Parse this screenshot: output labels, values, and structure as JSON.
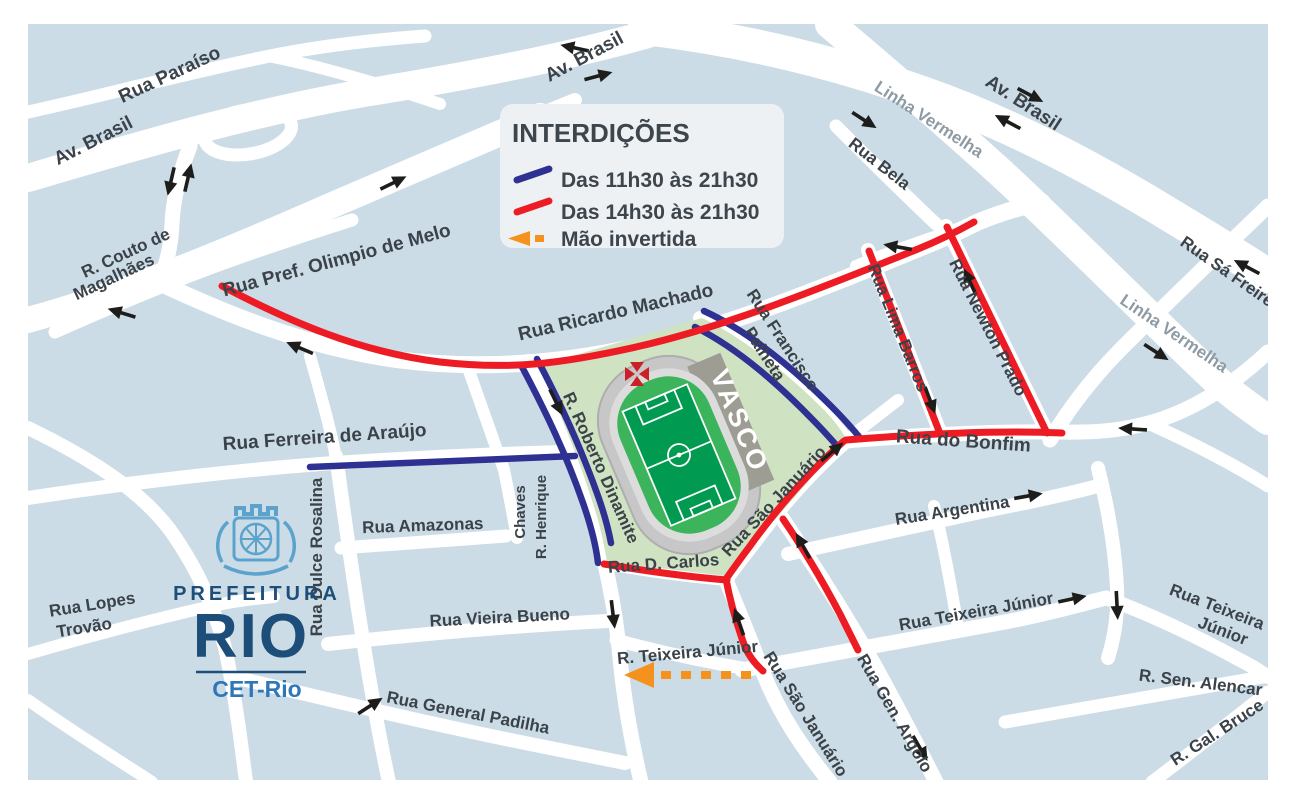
{
  "legend": {
    "title": "INTERDIÇÕES",
    "items": [
      {
        "id": "blue-closure",
        "swatch_icon": "blue-line-swatch",
        "color": "#2e3192",
        "label": "Das 11h30 às 21h30"
      },
      {
        "id": "red-closure",
        "swatch_icon": "red-line-swatch",
        "color": "#ed1c24",
        "label": "Das 14h30 às 21h30"
      },
      {
        "id": "inverted-lane",
        "swatch_icon": "orange-arrow-swatch",
        "color": "#f5921e",
        "label": "Mão invertida"
      }
    ]
  },
  "logo": {
    "prefeitura": "PREFEITURA",
    "rio": "RIO",
    "agency": "CET-Rio"
  },
  "stadium": {
    "name": "VASCO",
    "crest_icon": "vasco-cross-icon"
  },
  "icons": {
    "direction_arrow": "black one-way traffic arrow",
    "inverted_arrow": "orange dashed reversed-lane arrow"
  },
  "colors": {
    "map_background": "#cbdce6",
    "road": "#ffffff",
    "closure_blue": "#2e3192",
    "closure_red": "#ed1c24",
    "inverted_orange": "#f5921e",
    "stadium_grounds": "#cfe3c2",
    "pitch_green": "#009b50",
    "track_green": "#3cb45c",
    "stand_gray": "#c7c7c7",
    "label_dark": "#3b4249",
    "label_gray": "#8e9ba4"
  },
  "labels": {
    "rua_paraiso": "Rua Paraíso",
    "av_brasil_w": "Av. Brasil",
    "av_brasil_top": "Av. Brasil",
    "av_brasil_ne": "Av. Brasil",
    "linha_vermelha_top": "Linha Vermelha",
    "linha_vermelha_right": "Linha Vermelha",
    "rua_bela": "Rua Bela",
    "rua_sa_freire": "Rua Sá Freire",
    "couto_1": "R. Couto de",
    "couto_2": "Magalhães",
    "olimpio": "Rua Pref. Olimpio de Melo",
    "ricardo": "Rua Ricardo Machado",
    "francisco_1": "Rua Francisco",
    "francisco_2": "Palheta",
    "lima": "Rua Lima Barros",
    "newton": "Rua Newton Prado",
    "bonfim": "Rua do Bonfim",
    "argentina": "Rua Argentina",
    "ferreira": "Rua Ferreira de Araújo",
    "dulce": "Rua Dulce Rosalina",
    "amazonas": "Rua Amazonas",
    "henrique_1": "R. Henrique",
    "henrique_2": "Chaves",
    "roberto": "R. Roberto Dinamite",
    "d_carlos": "Rua D. Carlos",
    "sao_januario": "Rua São Januário",
    "sao_januario_lower": "Rua São Januário",
    "vieira": "Rua Vieira Bueno",
    "teixeira": "R. Teixeira Júnior",
    "teixeira_bottom": "Rua Teixeira Júnior",
    "teixeira_right_1": "Rua Teixeira",
    "teixeira_right_2": "Júnior",
    "sen_alencar": "R. Sen. Alencar",
    "gal_bruce": "R. Gal. Bruce",
    "gen_argolo": "Rua Gen. Argolo",
    "padilha": "Rua General Padilha",
    "lopes_1": "Rua Lopes",
    "lopes_2": "Trovão"
  }
}
